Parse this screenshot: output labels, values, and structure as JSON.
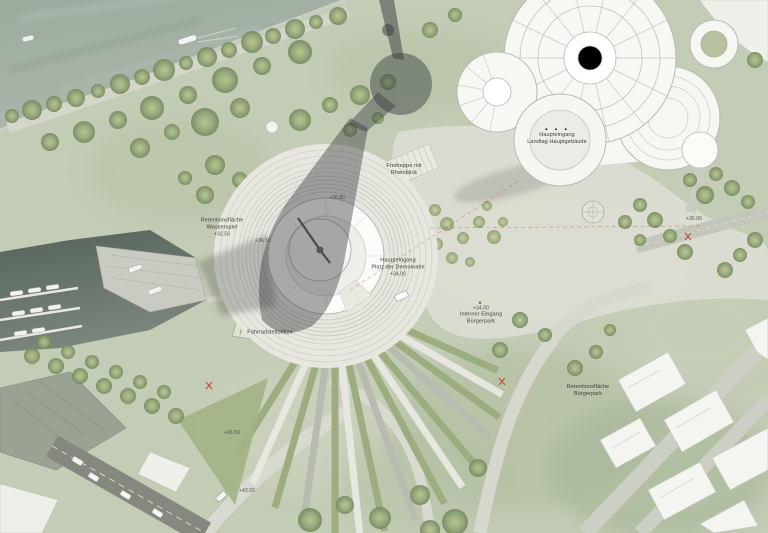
{
  "palette": {
    "park_green": "#c3ccb5",
    "river_water": "#a3afa7",
    "marina_water": "#5e6b62",
    "paving_light": "#e7e7e0",
    "building_white": "#f7f7f4",
    "road_dark": "#84887e",
    "tree_green": "#8ba172",
    "shadow_gray": "rgba(52,57,60,0.42)",
    "accent_red": "#c0392b"
  },
  "labels": {
    "retention_wasserspiel": {
      "lines": [
        "Retentionsfläche",
        "Wasserspiel",
        "+32.50"
      ]
    },
    "spot_plaza_inner": {
      "text": "+36.50"
    },
    "spot_plaza_top": {
      "text": "+36.80"
    },
    "freitreppe": {
      "lines": [
        "Freitreppe mit",
        "Rheinblick"
      ]
    },
    "haupteingang_landtag": {
      "arrows": "▲ ▲ ▲",
      "lines": [
        "Haupteingang",
        "Landtag Hauptgebäude"
      ]
    },
    "haupteingang_platz": {
      "lines": [
        "Haupteingang",
        "Platz der Demokratie",
        "+34.00"
      ],
      "arrow_glyph": "▶"
    },
    "interner_eingang": {
      "arrow_glyph": "▲",
      "lines": [
        "+34.00",
        "Interner Eingang",
        "Bürgerpark"
      ]
    },
    "retention_buergerpark": {
      "lines": [
        "Retentionsfläche",
        "Bürgerpark"
      ]
    },
    "spot_right_road": {
      "text": "+35.00"
    },
    "spot_west_path": {
      "text": "+36.50"
    },
    "spot_south_path": {
      "text": "+43.50"
    },
    "fahrradstellplaetze": {
      "text": "Fahrradstellplätze"
    }
  }
}
